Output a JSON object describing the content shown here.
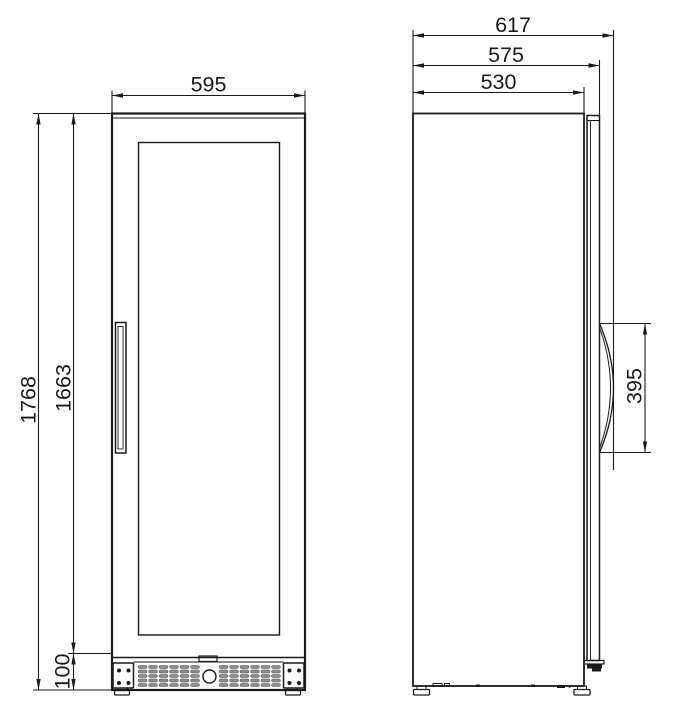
{
  "diagram": {
    "description": "Two-view dimensional line drawing of a tall glass-door cabinet (front view and right-side view) with millimetre dimensions",
    "front_view": {
      "dims": {
        "width": "595",
        "overall_height": "1768",
        "door_height": "1663",
        "base_height": "100"
      }
    },
    "side_view": {
      "dims": {
        "overall_depth": "617",
        "depth_without_handle": "575",
        "cabinet_depth": "530",
        "handle_length": "395"
      }
    },
    "colors": {
      "line": "#1a1a1a",
      "vent_slot": "#8f8f8f",
      "background": "#ffffff"
    }
  }
}
